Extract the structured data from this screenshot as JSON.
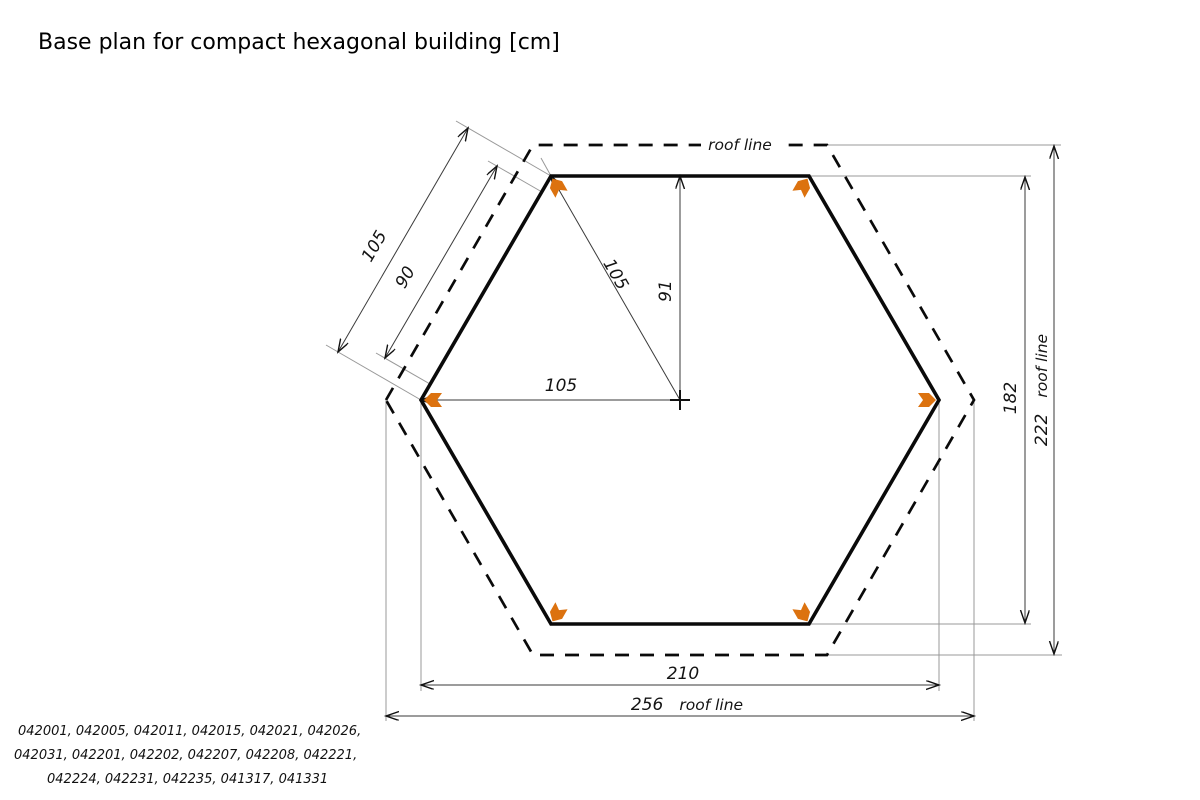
{
  "title": "Base plan for compact hexagonal building [cm]",
  "diagram": {
    "roof_line_label": "roof line",
    "marker_color": "#DC720F",
    "dimensions": {
      "edge_outer": "105",
      "edge_inner": "90",
      "radius": "105",
      "apothem": "91",
      "center_to_corner": "105",
      "wall_width": "210",
      "roof_width": "256",
      "wall_height": "182",
      "roof_height": "222"
    }
  },
  "footer": {
    "models_line1": "042001,  042005,  042011,  042015,  042021,  042026,",
    "models_line2": "042031,  042201,  042202,  042207,  042208,  042221,",
    "models_line3": "042224,  042231,  042235,  041317,  041331"
  }
}
